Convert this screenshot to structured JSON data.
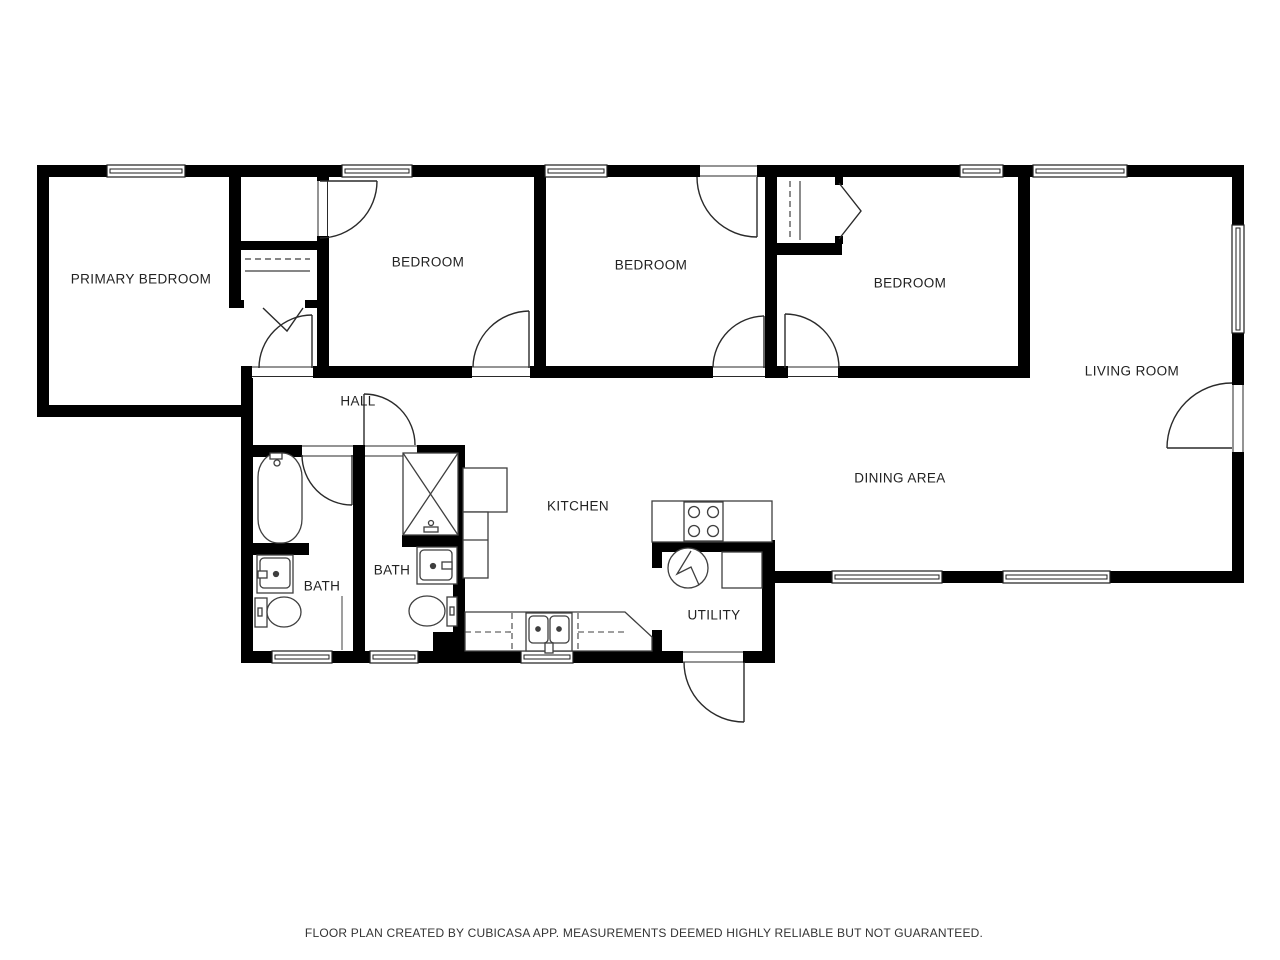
{
  "floor_plan": {
    "source_app_note": "FLOOR PLAN CREATED BY CUBICASA APP. MEASUREMENTS DEEMED HIGHLY RELIABLE BUT NOT GUARANTEED.",
    "rooms": [
      {
        "id": "primary-bedroom",
        "label": "PRIMARY BEDROOM"
      },
      {
        "id": "bedroom-1",
        "label": "BEDROOM"
      },
      {
        "id": "bedroom-2",
        "label": "BEDROOM"
      },
      {
        "id": "bedroom-3",
        "label": "BEDROOM"
      },
      {
        "id": "living-room",
        "label": "LIVING ROOM"
      },
      {
        "id": "hall",
        "label": "HALL"
      },
      {
        "id": "dining-area",
        "label": "DINING AREA"
      },
      {
        "id": "kitchen",
        "label": "KITCHEN"
      },
      {
        "id": "bath-1",
        "label": "BATH"
      },
      {
        "id": "bath-2",
        "label": "BATH"
      },
      {
        "id": "utility",
        "label": "UTILITY"
      }
    ],
    "colors": {
      "walls": "#000000",
      "background": "#ffffff",
      "fixture_lines": "#3f3f3f",
      "door_lines": "#2a2a2a",
      "text": "#222222"
    },
    "fixture_names": [
      "bathtub",
      "shower",
      "toilet",
      "vanity-sink",
      "kitchen-sink",
      "dishwasher-dashed",
      "stove-cooktop",
      "refrigerator",
      "kitchen-counter",
      "water-heater",
      "laundry-appliance",
      "closet-rod-dashed"
    ]
  }
}
